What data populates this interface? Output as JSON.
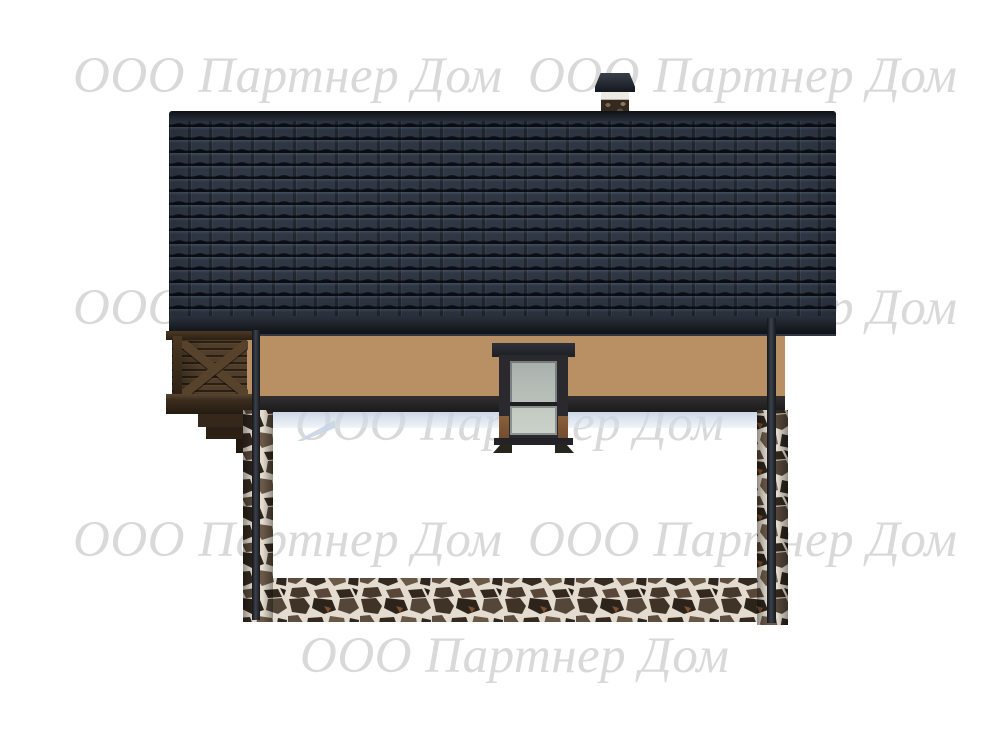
{
  "watermark": {
    "text": "ООО Партнер Дом",
    "color": "#d9d9d9",
    "style": "italic-serif",
    "visible_rows": 5
  },
  "colors": {
    "background": "#ffffff",
    "roof_tile": "#2f3744",
    "roof_ridge": "#12151b",
    "fascia": "#1b1f26",
    "wood_siding": "#b98f64",
    "wood_plank_gap": "#4e3620",
    "balcony_wood": "#503e2a",
    "rim_band": "#242224",
    "under_floor_shadow": "#ccd7e4",
    "window_frame": "#2a2a2e",
    "window_glass": "#b4bbb5",
    "window_lower_wood": "#8a5f3c",
    "chimney_band": "#eceae3",
    "chimney_stone": "#34291f",
    "stone_mortar": "#e3dccf",
    "stone_dark": "#352a20"
  }
}
